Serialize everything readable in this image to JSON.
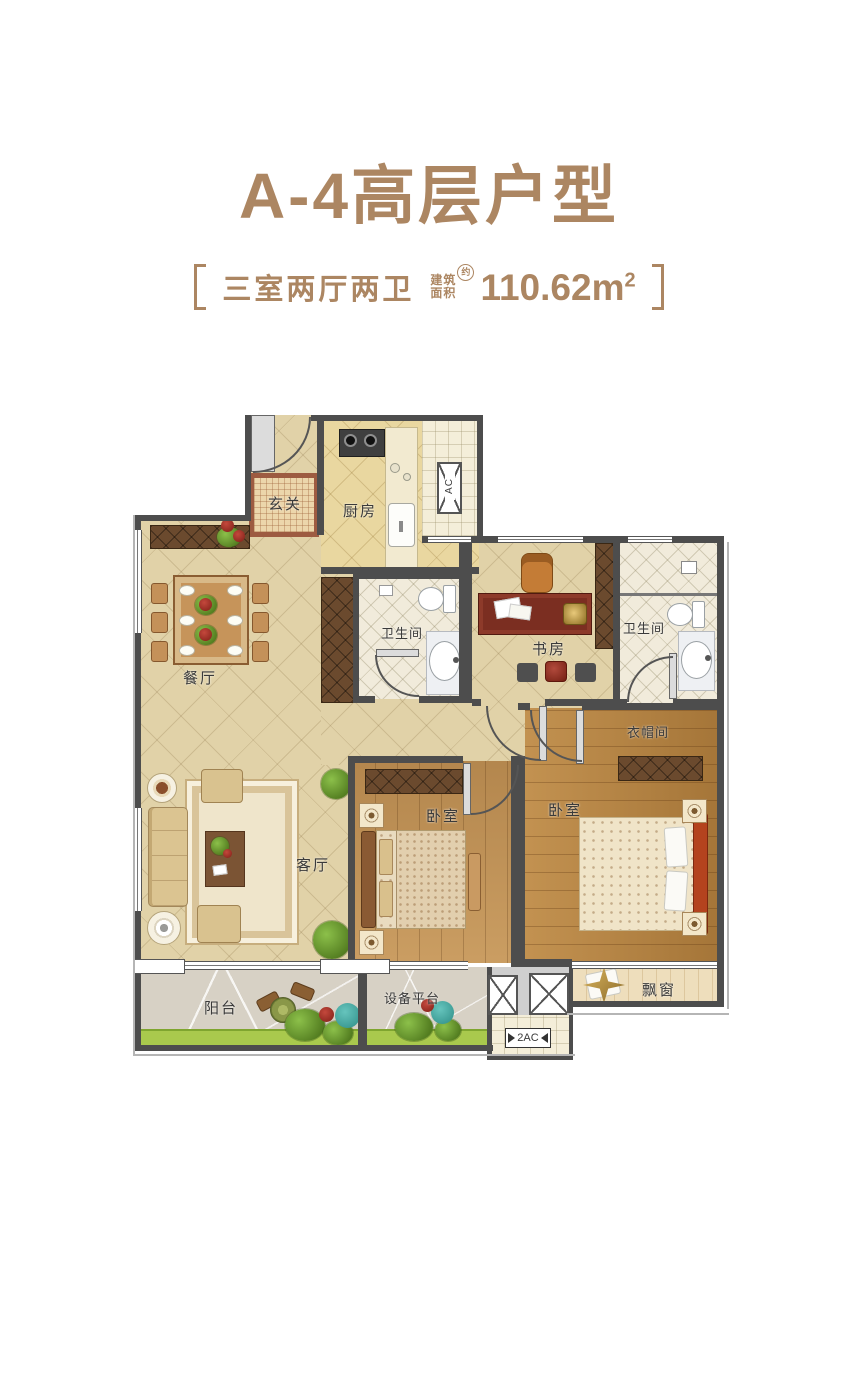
{
  "header": {
    "title": "A-4高层户型",
    "layout_text": "三室两厅两卫",
    "area_label_line1": "建筑",
    "area_label_line2": "面积",
    "area_approx": "约",
    "area_value": "110.62m",
    "area_unit_sup": "2"
  },
  "floorplan": {
    "rooms": {
      "entry": "玄关",
      "kitchen": "厨房",
      "bath1": "卫生间",
      "study": "书房",
      "bath2": "卫生间",
      "dining": "餐厅",
      "living": "客厅",
      "bedroom_small": "卧室",
      "bedroom_master": "卧室",
      "closet": "衣帽间",
      "balcony": "阳台",
      "equipment": "设备平台",
      "bay_window": "飘窗"
    },
    "annotations": {
      "ac": "AC",
      "ac2": "2AC"
    }
  },
  "colors": {
    "accent": "#ac8662",
    "wall": "#4d4d4d",
    "label": "#3a3a3a",
    "tile": "#e1d2a8",
    "wood_light": "#c39254",
    "wood_dark": "#b8833f",
    "cabinet": "#6b4a2e",
    "grass": "#a9c94d",
    "balcony_floor": "#d7d1c5"
  }
}
